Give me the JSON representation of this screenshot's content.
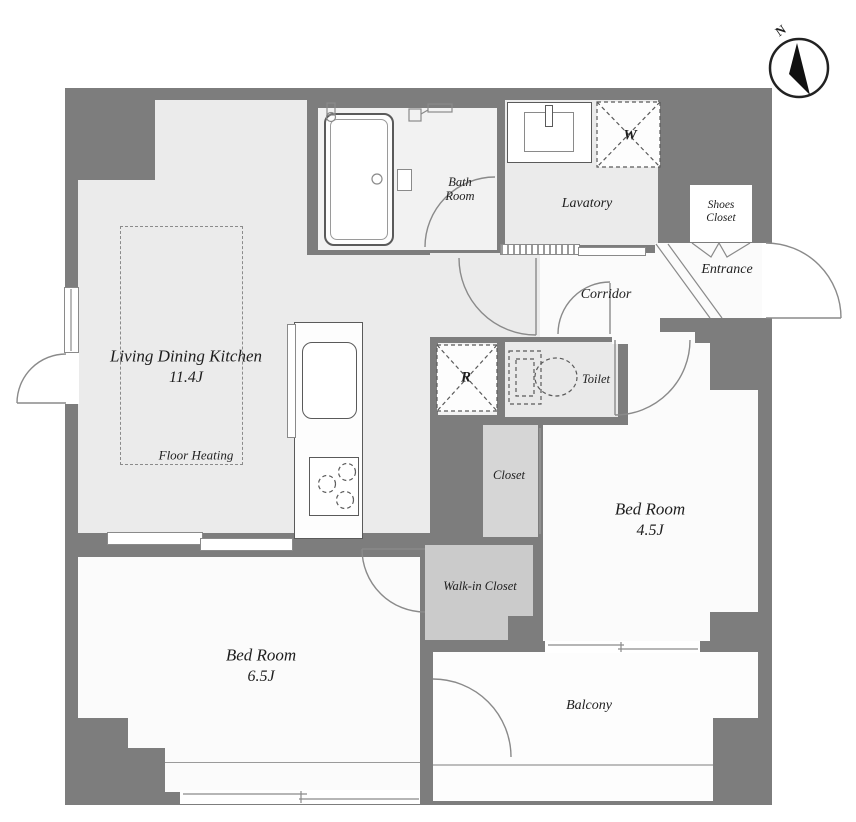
{
  "plan": {
    "title": "1LDK apartment floor plan",
    "compass": {
      "north": "N"
    },
    "rooms": {
      "ldk": {
        "name": "Living Dining Kitchen",
        "size": "11.4J"
      },
      "floor_heating": {
        "label": "Floor Heating"
      },
      "bath": {
        "line1": "Bath",
        "line2": "Room"
      },
      "lavatory": {
        "label": "Lavatory"
      },
      "washer": {
        "label": "W"
      },
      "shoes_closet": {
        "line1": "Shoes",
        "line2": "Closet"
      },
      "entrance": {
        "label": "Entrance"
      },
      "corridor": {
        "label": "Corridor"
      },
      "refrigerator": {
        "label": "R"
      },
      "toilet": {
        "label": "Toilet"
      },
      "closet": {
        "label": "Closet"
      },
      "walk_in_closet": {
        "label": "Walk-in Closet"
      },
      "bedroom_small": {
        "name": "Bed Room",
        "size": "4.5J"
      },
      "bedroom_large": {
        "name": "Bed Room",
        "size": "6.5J"
      },
      "balcony": {
        "label": "Balcony"
      }
    },
    "colors": {
      "wall": "#7d7d7d",
      "floor-ldk": "#ebebeb",
      "floor-bath": "#f2f2f2",
      "floor-white": "#fbfbfb",
      "floor-toilet": "#e9e9e9",
      "floor-closet": "#d6d6d6",
      "floor-wic": "#cbcbcb",
      "line": "#8a8a8a",
      "fixture": "#5a5a5a",
      "text": "#1e1e1e"
    }
  }
}
